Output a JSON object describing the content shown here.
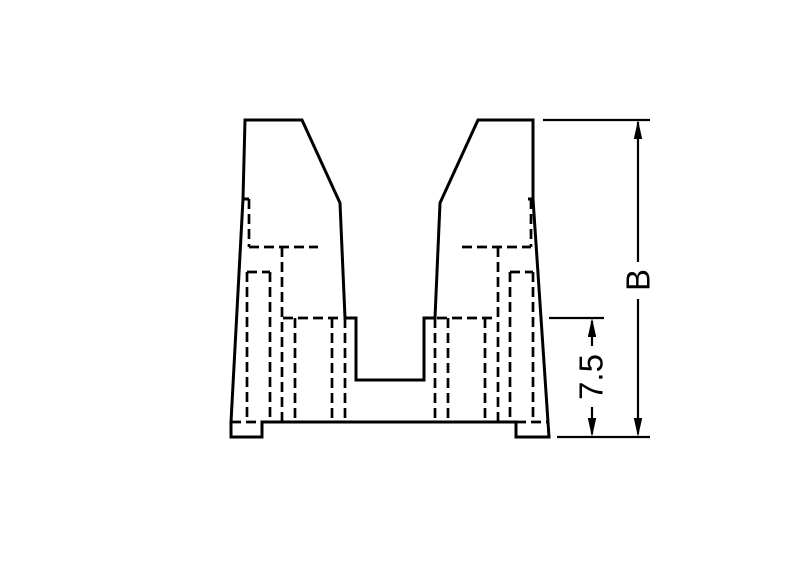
{
  "page": {
    "background_color": "#ffffff",
    "canvas": {
      "width": 800,
      "height": 576
    }
  },
  "diagram": {
    "type": "technical-drawing",
    "description": "Front cross-section view of a two-prong housing with hidden (dashed) internal contours and two vertical height dimensions",
    "line_color": "#000000",
    "labels": {
      "overall_height": "B",
      "step_height": "7.5"
    },
    "dimensions": [
      {
        "name": "overall-height",
        "label": "B"
      },
      {
        "name": "step-height",
        "label": "7.5"
      }
    ],
    "style": {
      "outline_stroke_width": 3,
      "hidden_stroke_width": 2.7,
      "hidden_dash_array": "10 5",
      "dim_stroke_width": 2.2,
      "label_font_size": 33
    },
    "geometry": {
      "viewbox": "0 0 800 576",
      "outline_paths": [
        "M245,120 L302,120 L340,203 L345,318 L356,318 L356,380 L424,380 L424,318 L435,318 L440,203 L478,120 L533,120 L533,199 L549,437 L516,437 L516,422 L262,422 L262,437 L231,437 L231,422 L243,199 Z",
        "M243,199 L249,199",
        "M528,199 L533,199"
      ],
      "hidden_paths": [
        "M249,199 L249,247",
        "M249,247 L318,247",
        "M282,247 L282,422",
        "M247,272 L270,272",
        "M247,272 L247,422",
        "M270,272 L270,422",
        "M295,318 L295,422",
        "M332,318 L332,422",
        "M345,318 L345,422",
        "M283,318 L343,318",
        "M231,422 L262,422",
        "M531,199 L531,247",
        "M462,247 L531,247",
        "M498,247 L498,422",
        "M510,272 L533,272",
        "M510,272 L510,422",
        "M533,272 L533,422",
        "M485,318 L485,422",
        "M448,318 L448,422",
        "M435,318 L435,422",
        "M437,318 L497,318",
        "M516,422 L549,422"
      ],
      "dimension_lines": [
        {
          "name": "extension-line-top",
          "path": "M543,120 L650,120"
        },
        {
          "name": "extension-line-bottom",
          "path": "M557,437 L650,437"
        },
        {
          "name": "extension-line-step",
          "path": "M549,318 L604,318"
        },
        {
          "name": "dim-b-line-upper",
          "path": "M638,122 L638,262"
        },
        {
          "name": "dim-b-line-lower",
          "path": "M638,299 L638,434"
        },
        {
          "name": "dim-step-line-upper",
          "path": "M592,321 L592,346"
        },
        {
          "name": "dim-step-line-lower",
          "path": "M592,407 L592,434"
        }
      ],
      "arrowheads": [
        {
          "name": "arrow-b-top",
          "points": "638,120 633.8,139 642.2,139"
        },
        {
          "name": "arrow-b-bottom",
          "points": "638,437 633.8,418 642.2,418"
        },
        {
          "name": "arrow-step-top",
          "points": "592,318 587.8,337 596.2,337"
        },
        {
          "name": "arrow-step-bottom",
          "points": "592,437 587.8,418 596.2,418"
        }
      ],
      "label_overall": {
        "x": 638,
        "y": 280,
        "rotation": -90
      },
      "label_step": {
        "x": 591,
        "y": 377,
        "rotation": -90
      }
    }
  }
}
